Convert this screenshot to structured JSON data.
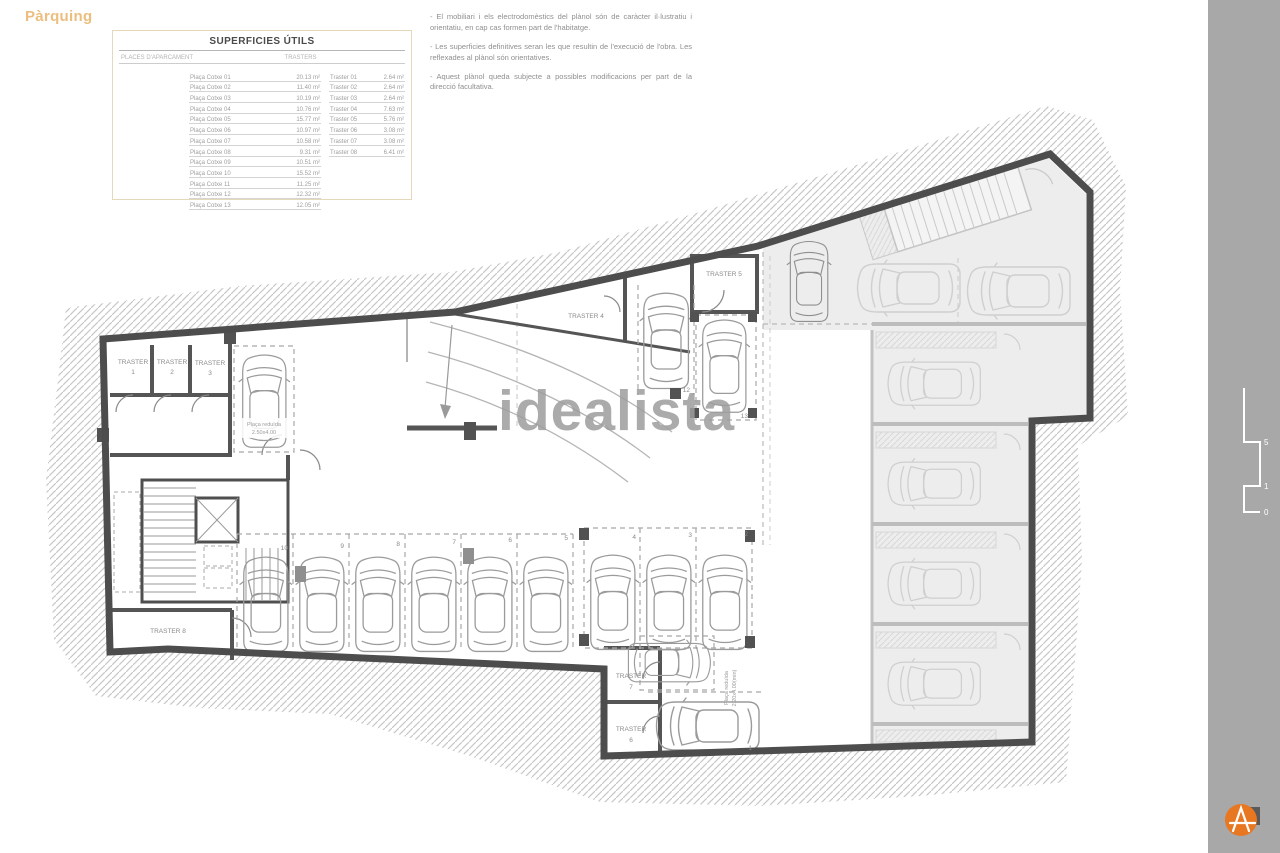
{
  "page": {
    "title": "Pàrquing"
  },
  "watermark": "idealista",
  "table": {
    "title": "SUPERFICIES ÚTILS",
    "col1_header": "PLACES D'APARCAMENT",
    "col2_header": "TRASTERS",
    "places": [
      {
        "label": "Plaça Cotxe 01",
        "value": "20.13 m²"
      },
      {
        "label": "Plaça Cotxe 02",
        "value": "11.40 m²"
      },
      {
        "label": "Plaça Cotxe 03",
        "value": "10.19 m²"
      },
      {
        "label": "Plaça Cotxe 04",
        "value": "10.76 m²"
      },
      {
        "label": "Plaça Cotxe 05",
        "value": "15.77 m²"
      },
      {
        "label": "Plaça Cotxe 06",
        "value": "10.97 m²"
      },
      {
        "label": "Plaça Cotxe 07",
        "value": "10.58 m²"
      },
      {
        "label": "Plaça Cotxe 08",
        "value": "9.31 m²"
      },
      {
        "label": "Plaça Cotxe 09",
        "value": "10.51 m²"
      },
      {
        "label": "Plaça Cotxe 10",
        "value": "15.52 m²"
      },
      {
        "label": "Plaça Cotxe 11",
        "value": "11.25 m²"
      },
      {
        "label": "Plaça Cotxe 12",
        "value": "12.32 m²"
      },
      {
        "label": "Plaça Cotxe 13",
        "value": "12.05 m²"
      }
    ],
    "trasters": [
      {
        "label": "Traster 01",
        "value": "2.64 m²"
      },
      {
        "label": "Traster 02",
        "value": "2.64 m²"
      },
      {
        "label": "Traster 03",
        "value": "2.64 m²"
      },
      {
        "label": "Traster 04",
        "value": "7.63 m²"
      },
      {
        "label": "Traster 05",
        "value": "5.76 m²"
      },
      {
        "label": "Traster 06",
        "value": "3.08 m²"
      },
      {
        "label": "Traster 07",
        "value": "3.08 m²"
      },
      {
        "label": "Traster 08",
        "value": "6.41 m²"
      }
    ]
  },
  "notes": [
    "- El mobiliari i els electrodomèstics del plànol són de caràcter il·lustratiu i orientatiu, en cap cas formen part de l'habitatge.",
    "- Les superficies definitives seran les que resultin de l'execució de l'obra. Les reflexades al plànol són orientatives.",
    "- Aquest plànol queda subjecte a possibles modificacions per part de la direcció facultativa."
  ],
  "plan": {
    "traster_word": "TRASTER",
    "trasters": {
      "t1": "1",
      "t2": "2",
      "t3": "3",
      "t6": "6",
      "t7": "7"
    },
    "traster_full": {
      "t4": "TRASTER 4",
      "t5": "TRASTER 5",
      "t8": "TRASTER 8"
    },
    "spaces": {
      "n1": "1",
      "n2": "2",
      "n3": "3",
      "n4": "4",
      "n5": "5",
      "n6": "6",
      "n7": "7",
      "n8": "8",
      "n9": "9",
      "n10": "10",
      "n12": "12",
      "n13": "13"
    },
    "reduced_top_line1": "Plaça reduïda",
    "reduced_top_line2": "2.50x4.00",
    "reduced_bottom_line1": "Plaça reduïda",
    "reduced_bottom_line2": "2.20x4.00(min)"
  },
  "sidebar": {
    "brand": "GMG",
    "address": "Carrer Bartrina 16-20, TERRASSA",
    "scale_ticks": {
      "t5": "5",
      "t1": "1",
      "t0": "0"
    },
    "escala": "escala:  A3   1/125",
    "project_line1": "EDIFICI DE 13 HABITATGES AMB",
    "project_line2": "APARCAMENT COMUNITARI",
    "logo_name": "ARMAT",
    "logo_sub": "H A B I T A T",
    "tagline": "vive mejor",
    "colors": {
      "accent": "#e87722",
      "sidebar_bg": "#a8a8a8",
      "heading": "#ecbe7e"
    }
  }
}
